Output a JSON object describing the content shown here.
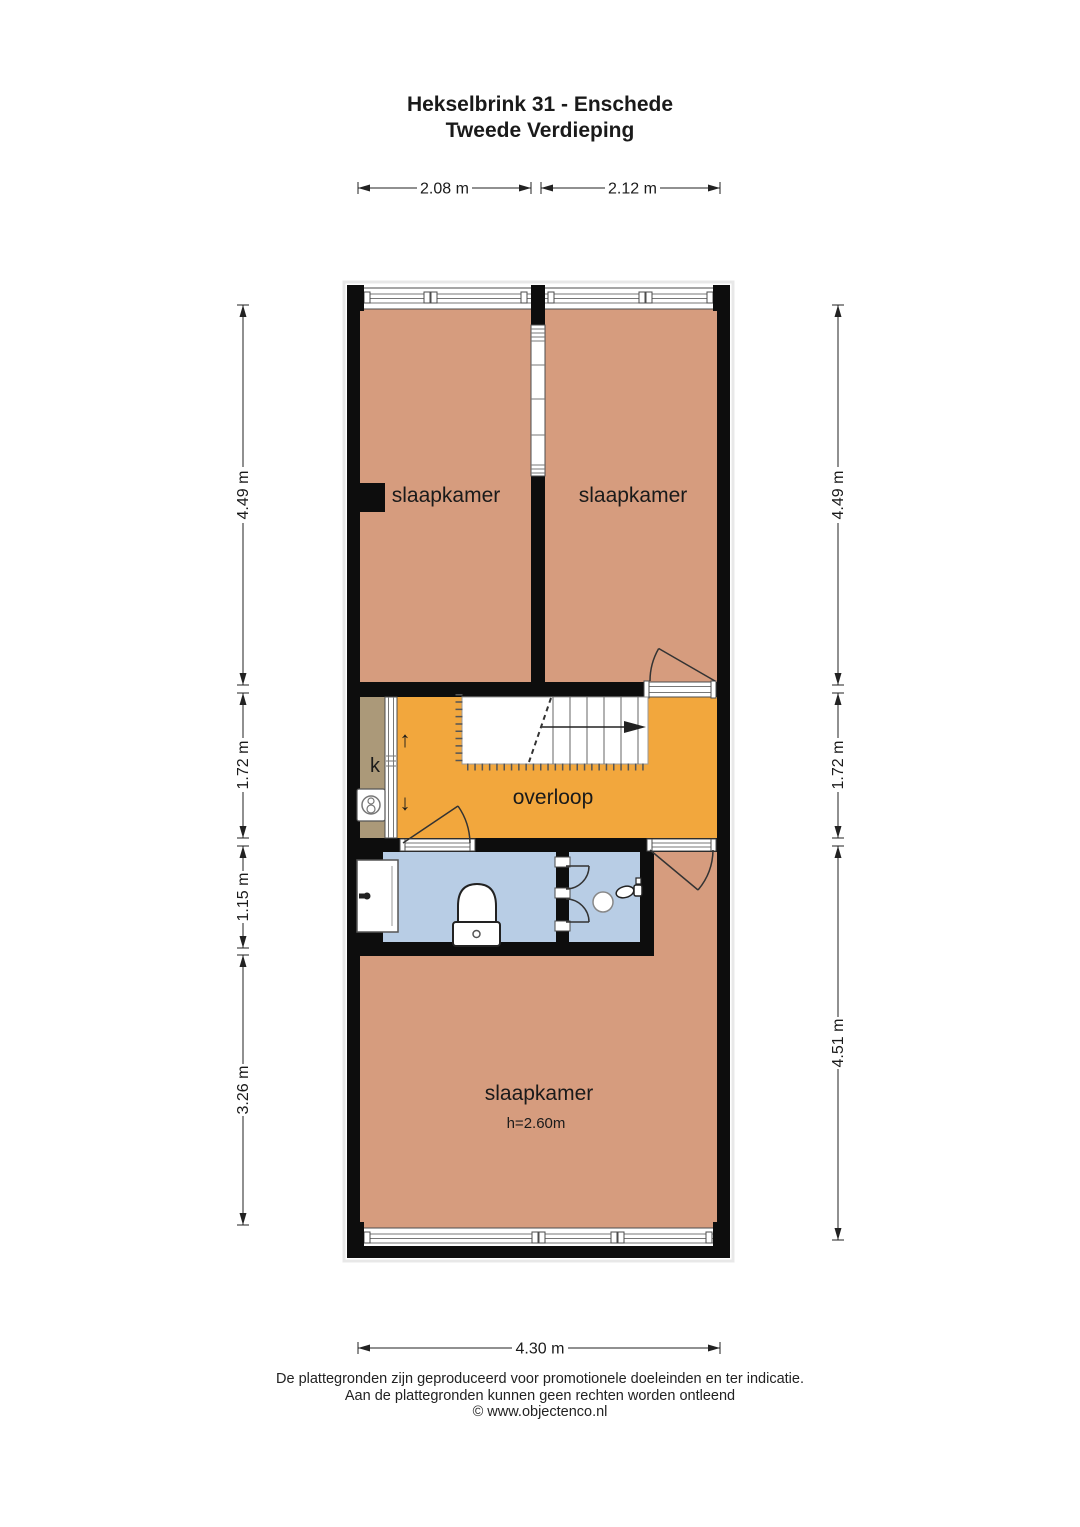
{
  "title": {
    "line1": "Hekselbrink 31 - Enschede",
    "line2": "Tweede Verdieping"
  },
  "dimensions": {
    "top": [
      {
        "label": "2.08 m"
      },
      {
        "label": "2.12 m"
      }
    ],
    "left": [
      {
        "label": "4.49 m"
      },
      {
        "label": "1.72 m"
      },
      {
        "label": "1.15 m"
      },
      {
        "label": "3.26 m"
      }
    ],
    "right": [
      {
        "label": "4.49 m"
      },
      {
        "label": "1.72 m"
      },
      {
        "label": "4.51 m"
      }
    ],
    "bottom": {
      "label": "4.30 m"
    }
  },
  "rooms": {
    "bedroom_top_left": {
      "label": "slaapkamer"
    },
    "bedroom_top_right": {
      "label": "slaapkamer"
    },
    "closet": {
      "label": "k"
    },
    "landing": {
      "label": "overloop",
      "up_arrow": "↑",
      "down_arrow": "↓"
    },
    "bedroom_bottom": {
      "label": "slaapkamer",
      "ceiling_height": "h=2.60m"
    }
  },
  "colors": {
    "bedroom_fill": "#D69C7E",
    "landing_fill": "#F2A73D",
    "bathroom_fill": "#B8CDE5",
    "closet_fill": "#AB9979",
    "wall": "#0d0d0d"
  },
  "footer": {
    "line1": "De plattegronden zijn geproduceerd voor promotionele doeleinden en ter indicatie.",
    "line2": "Aan de plattegronden kunnen geen rechten worden ontleend",
    "line3": "© www.objectenco.nl"
  }
}
